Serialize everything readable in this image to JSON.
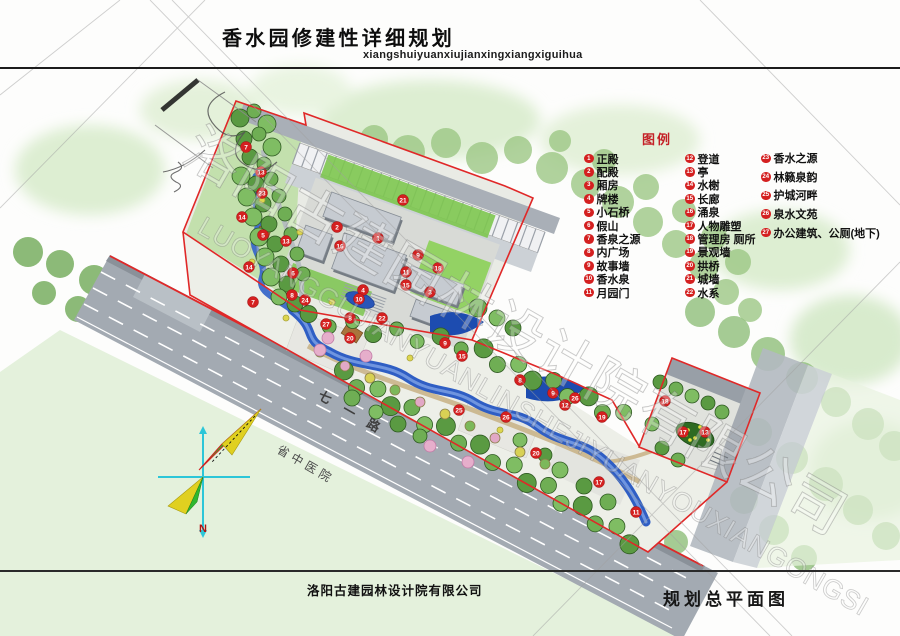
{
  "header": {
    "title": "香水园修建性详细规划",
    "pinyin": "xiangshuiyuanxiujianxingxiangxiguihua"
  },
  "legend": {
    "title": "图例",
    "col1": [
      {
        "n": "1",
        "label": "正殿"
      },
      {
        "n": "2",
        "label": "配殿"
      },
      {
        "n": "3",
        "label": "厢房"
      },
      {
        "n": "4",
        "label": "牌楼"
      },
      {
        "n": "5",
        "label": "小石桥"
      },
      {
        "n": "6",
        "label": "假山"
      },
      {
        "n": "7",
        "label": "香泉之源"
      },
      {
        "n": "8",
        "label": "内广场"
      },
      {
        "n": "9",
        "label": "故事墙"
      },
      {
        "n": "10",
        "label": "香水泉"
      },
      {
        "n": "11",
        "label": "月园门"
      }
    ],
    "col2": [
      {
        "n": "12",
        "label": "登道"
      },
      {
        "n": "13",
        "label": "亭"
      },
      {
        "n": "14",
        "label": "水榭"
      },
      {
        "n": "15",
        "label": "长廊"
      },
      {
        "n": "16",
        "label": "涌泉"
      },
      {
        "n": "17",
        "label": "人物雕塑"
      },
      {
        "n": "18",
        "label": "管理房 厕所"
      },
      {
        "n": "19",
        "label": "景观墙"
      },
      {
        "n": "20",
        "label": "拱桥"
      },
      {
        "n": "21",
        "label": "城墙"
      },
      {
        "n": "22",
        "label": "水系"
      }
    ],
    "col3": [
      {
        "n": "23",
        "label": "香水之源"
      },
      {
        "n": "24",
        "label": "林籁泉韵"
      },
      {
        "n": "25",
        "label": "护城河畔"
      },
      {
        "n": "26",
        "label": "泉水文苑"
      },
      {
        "n": "27",
        "label": "办公建筑、公厕(地下)"
      }
    ]
  },
  "map_labels": {
    "road": "七一路",
    "hospital": "省中医院",
    "compass_n": "N"
  },
  "watermark": {
    "line1": "洛阳古建园林设计院有限公司",
    "line2": "LUOYANGGUJIANYUANLINSHEJIYUANYOUXIANGONGSI"
  },
  "markers": [
    {
      "n": "7",
      "x": 246,
      "y": 147
    },
    {
      "n": "13",
      "x": 261,
      "y": 172
    },
    {
      "n": "23",
      "x": 262,
      "y": 193
    },
    {
      "n": "14",
      "x": 242,
      "y": 217
    },
    {
      "n": "5",
      "x": 263,
      "y": 235
    },
    {
      "n": "13",
      "x": 286,
      "y": 241
    },
    {
      "n": "6",
      "x": 293,
      "y": 273
    },
    {
      "n": "14",
      "x": 249,
      "y": 267
    },
    {
      "n": "7",
      "x": 253,
      "y": 302
    },
    {
      "n": "8",
      "x": 292,
      "y": 295
    },
    {
      "n": "24",
      "x": 305,
      "y": 300
    },
    {
      "n": "27",
      "x": 326,
      "y": 324
    },
    {
      "n": "2",
      "x": 337,
      "y": 227
    },
    {
      "n": "1",
      "x": 378,
      "y": 238
    },
    {
      "n": "16",
      "x": 340,
      "y": 246
    },
    {
      "n": "21",
      "x": 403,
      "y": 200
    },
    {
      "n": "9",
      "x": 418,
      "y": 255
    },
    {
      "n": "11",
      "x": 406,
      "y": 272
    },
    {
      "n": "15",
      "x": 406,
      "y": 285
    },
    {
      "n": "4",
      "x": 363,
      "y": 290
    },
    {
      "n": "10",
      "x": 359,
      "y": 299
    },
    {
      "n": "18",
      "x": 438,
      "y": 268
    },
    {
      "n": "3",
      "x": 430,
      "y": 292
    },
    {
      "n": "22",
      "x": 382,
      "y": 318
    },
    {
      "n": "8",
      "x": 350,
      "y": 318
    },
    {
      "n": "20",
      "x": 350,
      "y": 338
    },
    {
      "n": "9",
      "x": 445,
      "y": 343
    },
    {
      "n": "15",
      "x": 462,
      "y": 356
    },
    {
      "n": "8",
      "x": 520,
      "y": 380
    },
    {
      "n": "9",
      "x": 553,
      "y": 393
    },
    {
      "n": "26",
      "x": 575,
      "y": 398
    },
    {
      "n": "12",
      "x": 565,
      "y": 405
    },
    {
      "n": "19",
      "x": 602,
      "y": 417
    },
    {
      "n": "25",
      "x": 459,
      "y": 410
    },
    {
      "n": "26",
      "x": 506,
      "y": 417
    },
    {
      "n": "20",
      "x": 536,
      "y": 453
    },
    {
      "n": "17",
      "x": 599,
      "y": 482
    },
    {
      "n": "11",
      "x": 636,
      "y": 512
    },
    {
      "n": "18",
      "x": 665,
      "y": 401
    },
    {
      "n": "17",
      "x": 683,
      "y": 432
    },
    {
      "n": "13",
      "x": 705,
      "y": 432
    }
  ],
  "footer": {
    "company": "洛阳古建园林设计院有限公司",
    "drawing": "规划总平面图"
  },
  "colors": {
    "legend_red": "#c42127",
    "marker_red": "#d42020",
    "boundary_red": "#e02828",
    "stream_blue": "#2f5ec4",
    "canal_blue": "#1d4cb0",
    "road_gray": "#a3aab2",
    "tree_green": "#6fae54",
    "wash_green": "#9cc785",
    "compass_cyan": "#2cc6d8",
    "compass_green": "#2eb82e",
    "compass_yellow": "#e0d020",
    "north_red": "#b01212"
  }
}
